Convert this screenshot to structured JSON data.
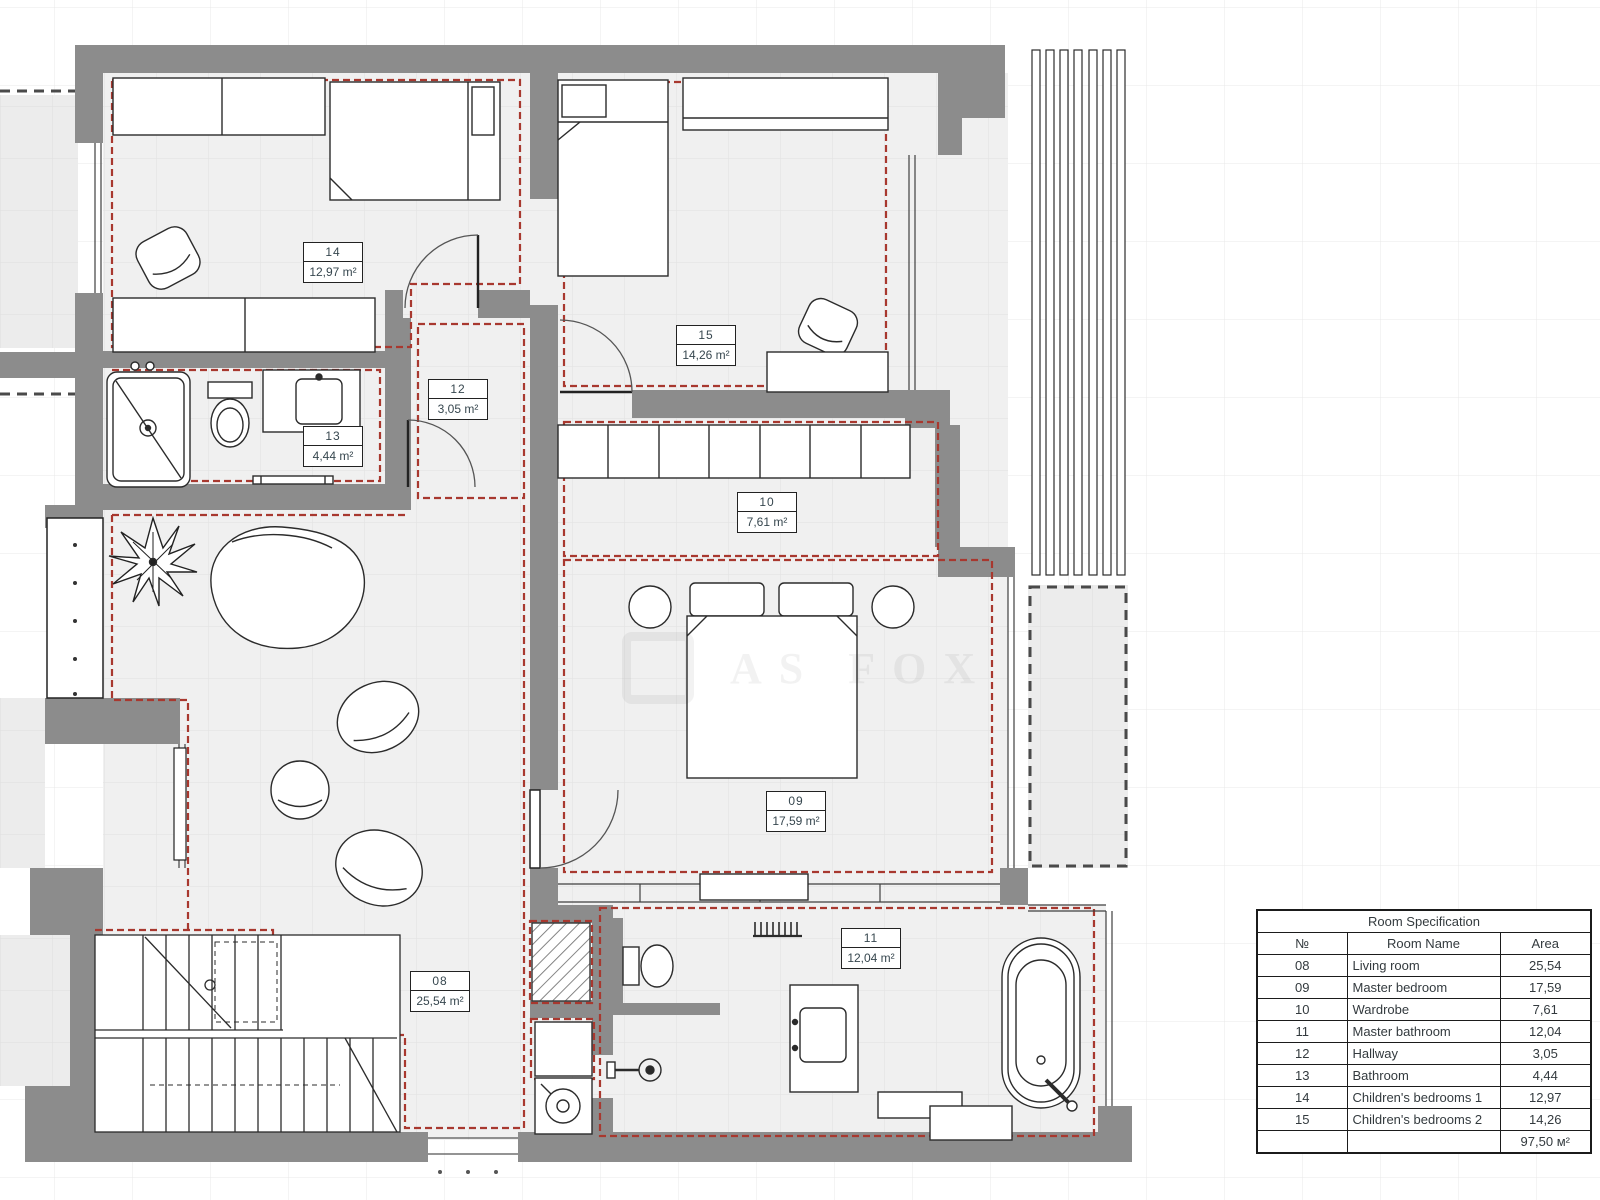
{
  "watermark": {
    "text": "AS FOX"
  },
  "plan_labels": [
    {
      "id": "08",
      "number": "08",
      "area": "25,54 m²"
    },
    {
      "id": "09",
      "number": "09",
      "area": "17,59 m²"
    },
    {
      "id": "10",
      "number": "10",
      "area": "7,61 m²"
    },
    {
      "id": "11",
      "number": "11",
      "area": "12,04 m²"
    },
    {
      "id": "12",
      "number": "12",
      "area": "3,05 m²"
    },
    {
      "id": "13",
      "number": "13",
      "area": "4,44 m²"
    },
    {
      "id": "14",
      "number": "14",
      "area": "12,97 m²"
    },
    {
      "id": "15",
      "number": "15",
      "area": "14,26 m²"
    }
  ],
  "spec_table": {
    "title": "Room Specification",
    "columns": [
      "№",
      "Room Name",
      "Area"
    ],
    "rows": [
      {
        "no": "08",
        "name": "Living room",
        "area": "25,54"
      },
      {
        "no": "09",
        "name": "Master bedroom",
        "area": "17,59"
      },
      {
        "no": "10",
        "name": "Wardrobe",
        "area": "7,61"
      },
      {
        "no": "11",
        "name": "Master bathroom",
        "area": "12,04"
      },
      {
        "no": "12",
        "name": "Hallway",
        "area": "3,05"
      },
      {
        "no": "13",
        "name": "Bathroom",
        "area": "4,44"
      },
      {
        "no": "14",
        "name": "Children's bedrooms 1",
        "area": "12,97"
      },
      {
        "no": "15",
        "name": "Children's bedrooms 2",
        "area": "14,26"
      }
    ],
    "total_area": "97,50 м²"
  },
  "colors": {
    "wall": "#8c8c8c",
    "room_dash": "#a8382f",
    "terrace_dash": "#4a4a4a",
    "floor": "#f0f0f0"
  }
}
